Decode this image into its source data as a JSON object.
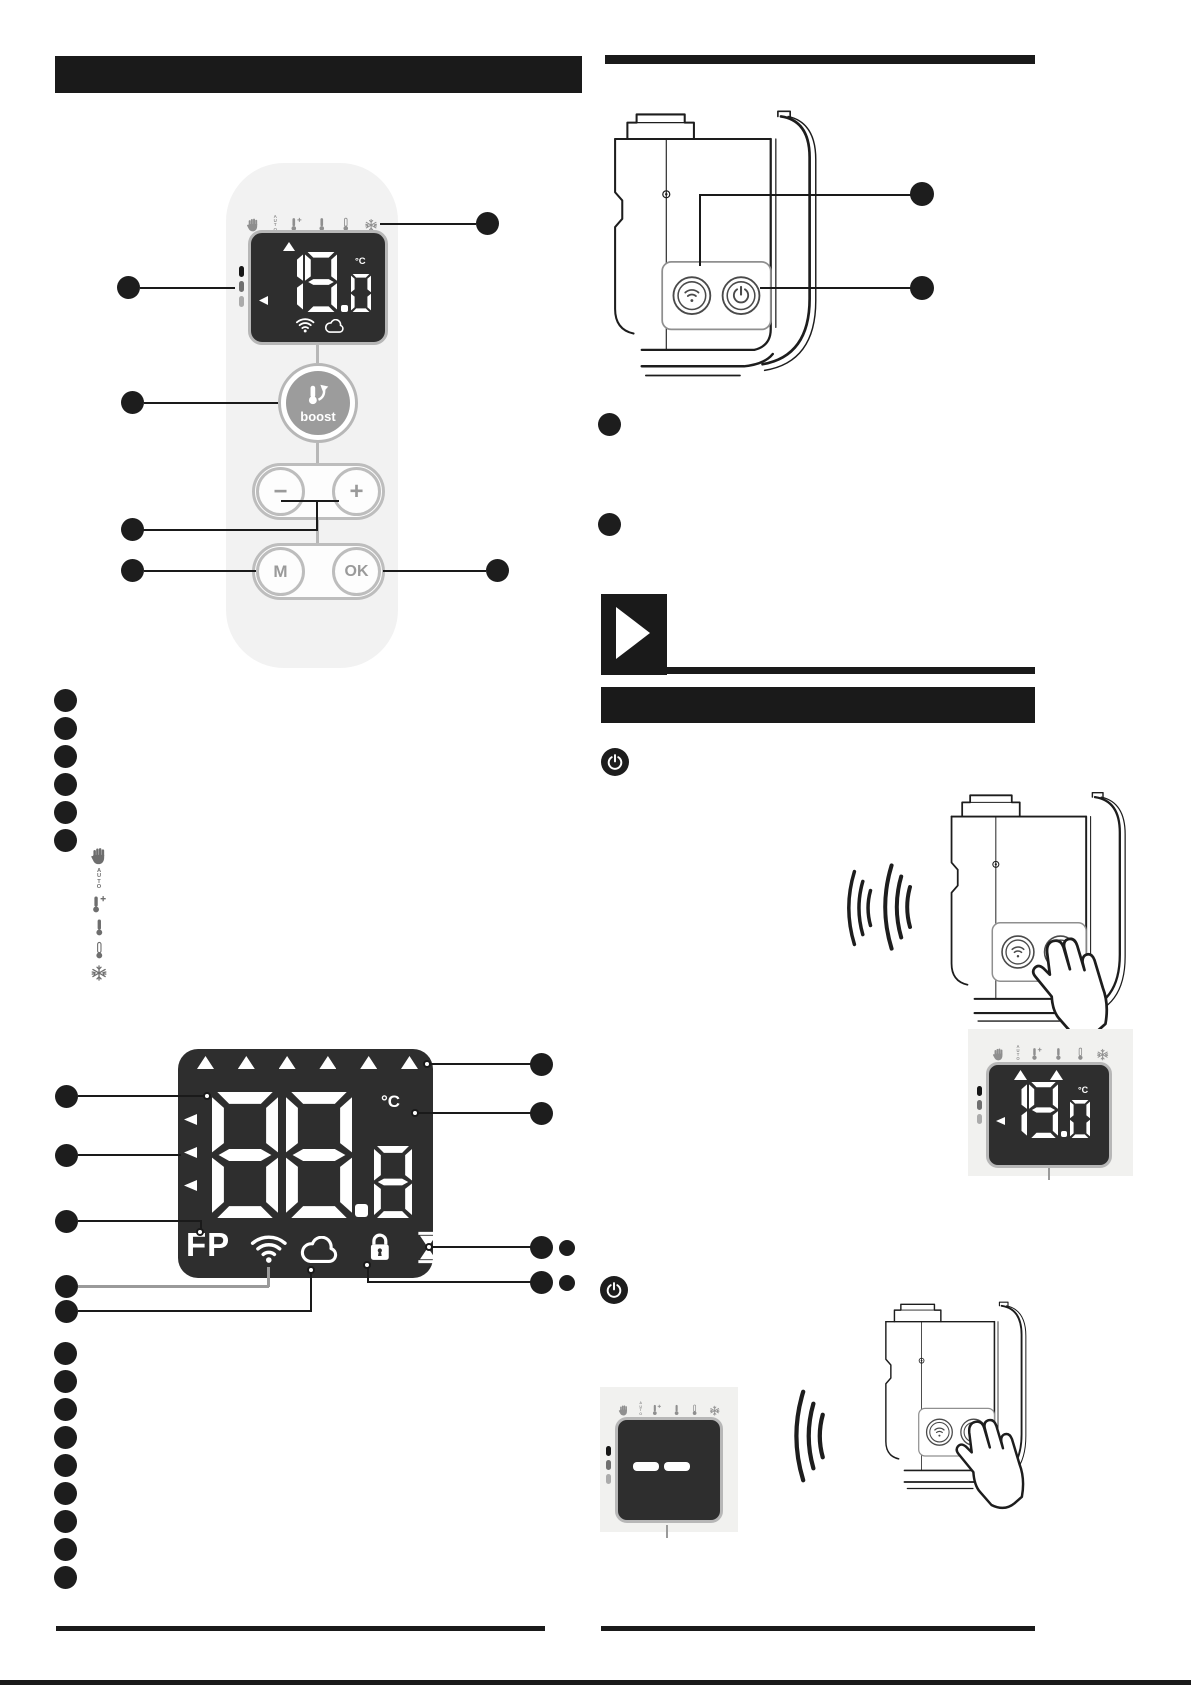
{
  "page_type": "heater-user-manual-page",
  "colors": {
    "ink": "#1a1a1a",
    "display_bg": "#2e2e2e",
    "panel_bg": "#f1f1ef",
    "remote_bg": "#f2f2f2",
    "ring_gray": "#b7b7b7",
    "icon_gray": "#6e6e6e",
    "boost_fill": "#9c9c9c"
  },
  "auto_label": "AUTO",
  "remote": {
    "mode_icons": [
      "hand",
      "auto",
      "thermometer-plus",
      "thermometer",
      "thermometer-low",
      "snowflake"
    ],
    "display": {
      "digits": [
        "1",
        "9"
      ],
      "decimal_digit": "0",
      "unit": "°C",
      "status_icons": [
        "wifi",
        "cloud"
      ]
    },
    "boost_label": "boost",
    "minus_label": "−",
    "plus_label": "+",
    "menu_label": "M",
    "ok_label": "OK"
  },
  "callout_bullets": {
    "remote_list_count": 6,
    "display_list_count": 9,
    "device_list_count": 2,
    "power_off_list_count": 2
  },
  "legend": {
    "mode_icons": [
      "hand",
      "auto",
      "thermometer-plus",
      "thermometer",
      "thermometer-low",
      "snowflake"
    ]
  },
  "display_legend": {
    "digits": [
      "8",
      "8"
    ],
    "decimal_digit": "8",
    "unit": "°C",
    "fp_label": "FP",
    "status_icons": [
      "wifi",
      "cloud",
      "lock",
      "hourglass"
    ]
  },
  "device_panel": {
    "buttons": [
      "wifi",
      "power"
    ]
  },
  "power_on_step": {
    "icon": "power",
    "mode_icons": [
      "hand",
      "auto",
      "thermometer-plus",
      "thermometer",
      "thermometer-low",
      "snowflake"
    ],
    "screen": {
      "digits": [
        "1",
        "9"
      ],
      "decimal_digit": "0",
      "unit": "°C"
    }
  },
  "power_off_step": {
    "icon": "power",
    "mode_icons": [
      "hand",
      "auto",
      "thermometer-plus",
      "thermometer",
      "thermometer-low",
      "snowflake"
    ],
    "screen": {
      "digits": [
        "-",
        "-"
      ]
    }
  }
}
